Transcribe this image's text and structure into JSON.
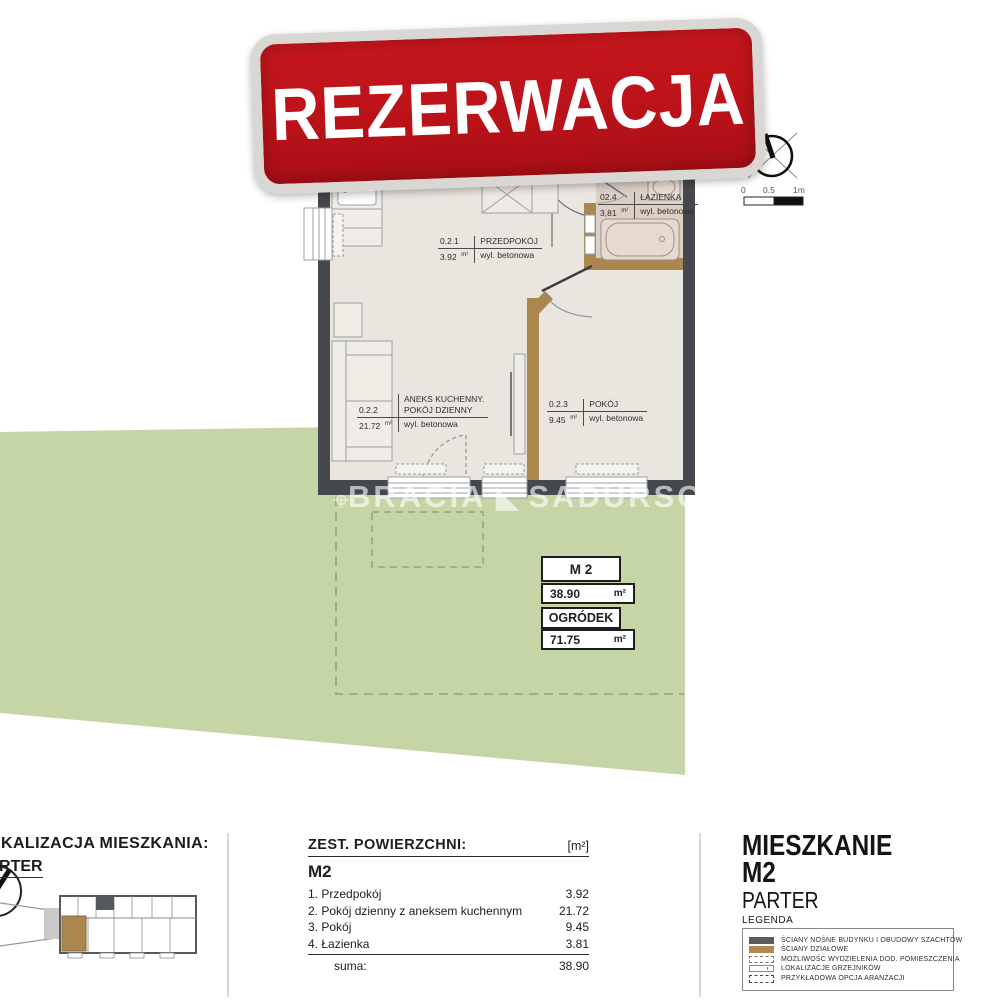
{
  "banner": {
    "label": "REZERWACJA"
  },
  "compass": {
    "north_label": "PN"
  },
  "scale_bar": {
    "tick_0": "0",
    "tick_half": "0.5",
    "tick_1": "1m"
  },
  "floor_plan": {
    "rooms": [
      {
        "id": "0.2.1",
        "name": "PRZEDPOKÓJ",
        "area": "3.92",
        "area_unit": "m²",
        "floor_type": "wyl. betonowa"
      },
      {
        "id": "0.2.2",
        "name_line1": "ANEKS KUCHENNY.",
        "name_line2": "POKÓJ DZIENNY",
        "area": "21.72",
        "area_unit": "m²",
        "floor_type": "wyl. betonowa"
      },
      {
        "id": "0.2.3",
        "name": "POKÓJ",
        "area": "9.45",
        "area_unit": "m²",
        "floor_type": "wyl. betonowa"
      },
      {
        "id": "02.4",
        "name": "ŁAZIENKA",
        "area": "3,81",
        "area_unit": "m²",
        "floor_type": "wyl. betonowa"
      }
    ]
  },
  "watermark": {
    "word1": "BRACIA",
    "logo_glyph": "◣",
    "word2": "SADURSCY"
  },
  "summary_boxes": {
    "unit_name": "M 2",
    "unit_area": "38.90",
    "unit_area_unit": "m²",
    "garden_label": "OGRÓDEK",
    "garden_area": "71.75",
    "garden_area_unit": "m²"
  },
  "footer": {
    "location": {
      "title": "LOKALIZACJA MIESZKANIA:",
      "floor_label": "PARTER"
    },
    "area_table": {
      "title": "ZEST. POWIERZCHNI:",
      "unit_header": "[m²]",
      "apartment_code": "M2",
      "rows": [
        {
          "label": "1. Przedpokój",
          "value": "3.92"
        },
        {
          "label": "2. Pokój dzienny z aneksem kuchennym",
          "value": "21.72"
        },
        {
          "label": "3. Pokój",
          "value": "9.45"
        },
        {
          "label": "4. Łazienka",
          "value": "3.81"
        }
      ],
      "sum_label": "suma:",
      "sum_value": "38.90"
    },
    "title_block": {
      "title_line1": "MIESZKANIE",
      "title_line2": "M2",
      "subtitle": "PARTER",
      "legend_title": "LEGENDA",
      "legend": [
        {
          "label": "ŚCIANY NOŚNE BUDYNKU I OBUDOWY SZACHTÓW"
        },
        {
          "label": "ŚCIANY DZIAŁOWE"
        },
        {
          "label": "MOŻLIWOŚĆ WYDZIELENIA DOD. POMIESZCZENIA"
        },
        {
          "label": "LOKALIZACJE GRZEJNIKÓW"
        },
        {
          "label": "PRZYKŁADOWA OPCJA ARANŻACJI"
        }
      ]
    }
  },
  "colors": {
    "banner_red": "#bb1219",
    "wall_bearing": "#45494d",
    "wall_partition": "#ab8750",
    "garden_green": "#c5d5a5",
    "floor": "#e9e6e0",
    "bathroom_floor": "#dccfc6"
  }
}
